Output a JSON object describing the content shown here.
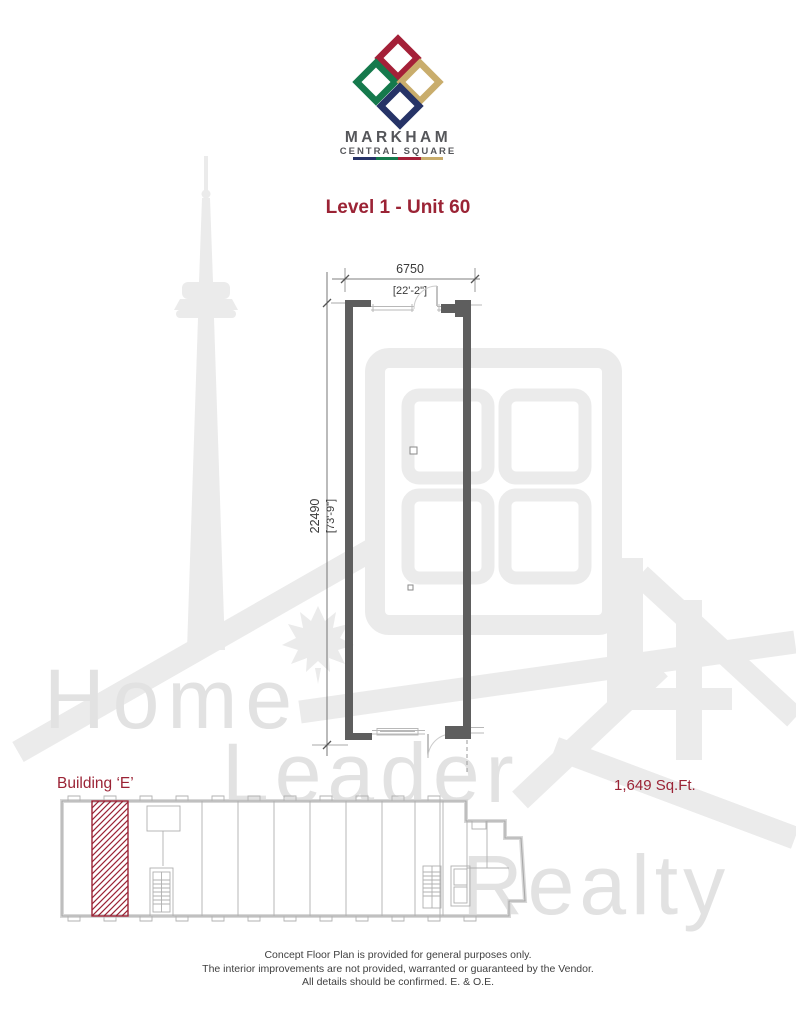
{
  "page": {
    "background": "#FFFFFF"
  },
  "logo": {
    "name": "MARKHAM",
    "subtitle": "CENTRAL SQUARE",
    "diamond_colors": {
      "red": "#A42038",
      "green": "#15794C",
      "tan": "#C9AD6C",
      "navy": "#263367"
    },
    "bar_colors": [
      "#263367",
      "#15794C",
      "#A42038",
      "#C9AD6C"
    ]
  },
  "title": {
    "text": "Level 1 - Unit 60",
    "color": "#9B2335"
  },
  "plan": {
    "width_metric": "6750",
    "width_imperial": "[22'-2\"]",
    "height_metric": "22490",
    "height_imperial": "[73'-9\"]",
    "wall_color": "#5E5E5E"
  },
  "building": {
    "label": "Building ‘E’",
    "area": "1,649 Sq.Ft.",
    "hatch_color": "#9B2335"
  },
  "watermark": {
    "word1": "Home",
    "word2": "Leader",
    "word3": "Realty",
    "color": "#E6E6E6"
  },
  "disclaimer": {
    "line1": "Concept Floor Plan is provided for general purposes only.",
    "line2": "The interior improvements are not provided, warranted or guaranteed by the Vendor.",
    "line3": "All details should be confirmed.  E. & O.E."
  }
}
